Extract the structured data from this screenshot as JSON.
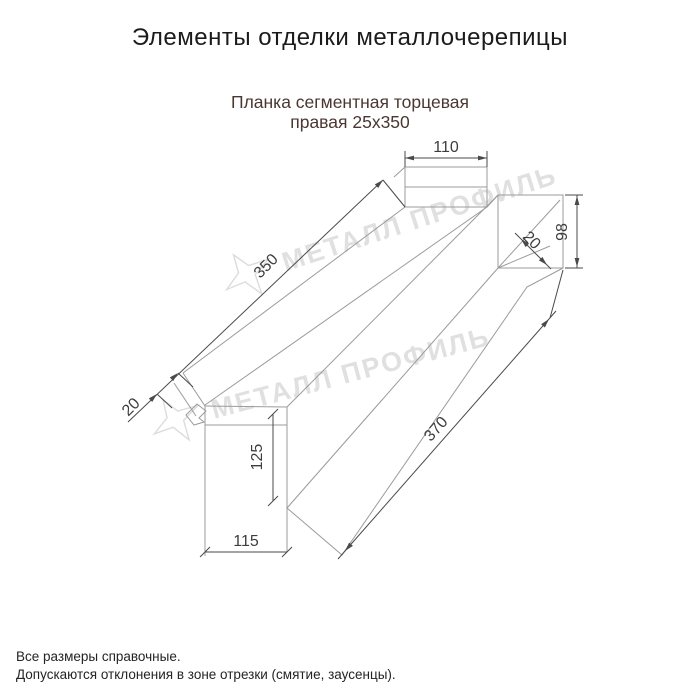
{
  "page": {
    "title": "Элементы отделки металлочерепицы",
    "subtitle_line1": "Планка сегментная торцевая",
    "subtitle_line2": "правая 25х350",
    "notes": [
      "Все размеры справочные.",
      "Допускаются отклонения в зоне отрезки (смятие, заусенцы)."
    ]
  },
  "watermark": {
    "text": "МЕТАЛЛ ПРОФИЛЬ",
    "logo": "compass-rose-icon",
    "color": "#d9d9d9"
  },
  "drawing": {
    "type": "dimensioned technical drawing of segmental end strip, right, 25x350",
    "line_color": "#9b9b9b",
    "dimension_color": "#4a4a4a",
    "dimensions": {
      "top_flange_width": "110",
      "length_top": "350",
      "left_hem": "20",
      "right_end_height": "98",
      "right_hem": "20",
      "left_end_height": "125",
      "left_end_width": "115",
      "length_bottom": "370"
    }
  }
}
